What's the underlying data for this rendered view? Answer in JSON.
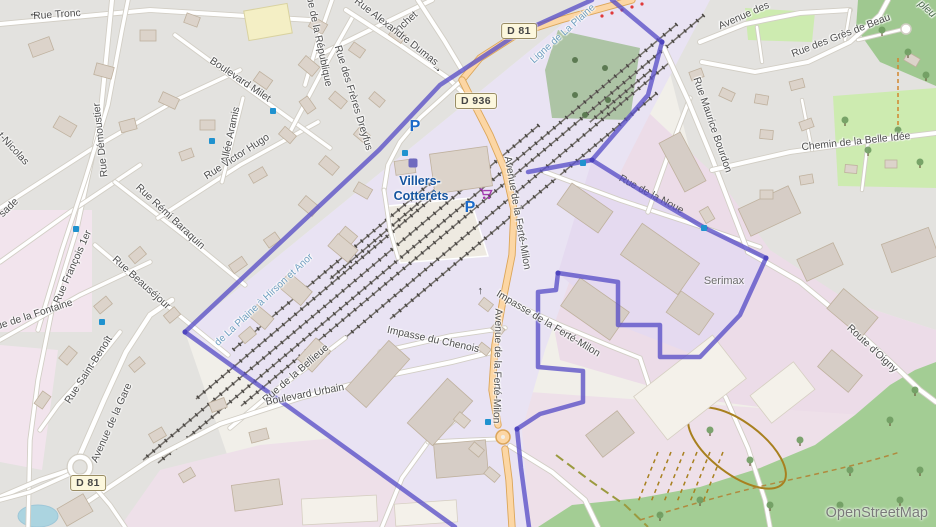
{
  "map": {
    "attribution": "OpenStreetMap",
    "station": {
      "line1": "Villers-",
      "line2": "Cotterêts",
      "x": 420,
      "y1": 181,
      "y2": 196
    },
    "poi_labels": [
      {
        "t": "Serimax",
        "x": 724,
        "y": 281
      }
    ],
    "forest_label": {
      "t": "pleu",
      "x": 927,
      "y": 9,
      "r": 42
    },
    "road_badges": [
      {
        "ref": "D 81",
        "x": 519,
        "y": 31
      },
      {
        "ref": "D 936",
        "x": 476,
        "y": 101
      },
      {
        "ref": "D 81",
        "x": 88,
        "y": 483
      }
    ],
    "street_labels": [
      {
        "t": "Rue Tronc",
        "x": 57,
        "y": 15,
        "r": -4
      },
      {
        "t": "nchet",
        "x": 407,
        "y": 22,
        "r": -42
      },
      {
        "t": "Rue de la République",
        "x": 318,
        "y": 38,
        "r": 78
      },
      {
        "t": "Rue Alexandre Dumas",
        "x": 396,
        "y": 32,
        "r": 38
      },
      {
        "t": "Rue des Frères Dreyfus",
        "x": 353,
        "y": 98,
        "r": 73
      },
      {
        "t": "Rue Démoustier",
        "x": 101,
        "y": 140,
        "r": -96
      },
      {
        "t": "Boulevard Milet",
        "x": 240,
        "y": 80,
        "r": 34
      },
      {
        "t": "Allée Aramis",
        "x": 231,
        "y": 135,
        "r": -78
      },
      {
        "t": "Rue Victor Hugo",
        "x": 237,
        "y": 157,
        "r": -33
      },
      {
        "t": "t-Nicolas",
        "x": 13,
        "y": 149,
        "r": 47
      },
      {
        "t": "sade",
        "x": 9,
        "y": 208,
        "r": -44
      },
      {
        "t": "Rue François 1er",
        "x": 73,
        "y": 267,
        "r": -66
      },
      {
        "t": "Rue Rémi Baraquin",
        "x": 170,
        "y": 217,
        "r": 43
      },
      {
        "t": "Rue Beauséjour",
        "x": 141,
        "y": 283,
        "r": 42
      },
      {
        "t": "Rue de la Fontaine",
        "x": 31,
        "y": 316,
        "r": -18
      },
      {
        "t": "Rue Saint-Benoît",
        "x": 89,
        "y": 370,
        "r": -57
      },
      {
        "t": "Avenue de la Gare",
        "x": 112,
        "y": 423,
        "r": -66
      },
      {
        "t": "Avenue de la Ferté-Milon",
        "x": 517,
        "y": 213,
        "r": 80
      },
      {
        "t": "Avenue de la Ferté-Milon",
        "x": 497,
        "y": 366,
        "r": 91
      },
      {
        "t": "Impasse de la Ferté-Milon",
        "x": 548,
        "y": 324,
        "r": 31
      },
      {
        "t": "Impasse du Chenois",
        "x": 433,
        "y": 340,
        "r": 12
      },
      {
        "t": "Rue de la Bellieue",
        "x": 296,
        "y": 374,
        "r": -41
      },
      {
        "t": "Boulevard Urbain",
        "x": 305,
        "y": 395,
        "r": -11
      },
      {
        "t": "Rue Maurice Bourdon",
        "x": 712,
        "y": 125,
        "r": 71
      },
      {
        "t": "Chemin de la Belle Idée",
        "x": 856,
        "y": 142,
        "r": -6
      },
      {
        "t": "Rue des Grès de Beau",
        "x": 841,
        "y": 36,
        "r": -21
      },
      {
        "t": "Avenue des",
        "x": 744,
        "y": 16,
        "r": -24
      },
      {
        "t": "Route d'Oigny",
        "x": 872,
        "y": 349,
        "r": 43
      }
    ],
    "railway_labels": [
      {
        "t": "Ligne de La Plaine",
        "x": 563,
        "y": 34,
        "r": -42
      },
      {
        "t": "de La Plaine à Hirson et Anor",
        "x": 264,
        "y": 300,
        "r": -43
      }
    ],
    "hidden_street_label": {
      "t": "Rue de la Noue",
      "x": 650,
      "y": 197,
      "r": 28
    },
    "icons": {
      "parking_glyph": "P",
      "parking": [
        {
          "x": 415,
          "y": 127
        },
        {
          "x": 470,
          "y": 208
        }
      ],
      "supermarket_cart": {
        "x": 479,
        "y": 188
      },
      "station_square": {
        "x": 413,
        "y": 163
      },
      "bus_stops": [
        {
          "x": 273,
          "y": 111
        },
        {
          "x": 212,
          "y": 141
        },
        {
          "x": 76,
          "y": 229
        },
        {
          "x": 102,
          "y": 322
        },
        {
          "x": 405,
          "y": 153
        },
        {
          "x": 583,
          "y": 163
        },
        {
          "x": 704,
          "y": 228
        },
        {
          "x": 488,
          "y": 422
        }
      ],
      "oneway_glyph": "→",
      "oneway_arrows": [
        {
          "x": 34,
          "y": 16,
          "r": 180
        },
        {
          "x": 437,
          "y": 68,
          "r": 35
        },
        {
          "x": 479,
          "y": 291,
          "r": -90
        }
      ]
    },
    "colors": {
      "boundary": "#5a50c7",
      "primary_road": "#fcd6a4",
      "residential": "#e3e2df",
      "industrial": "#ecdce8",
      "railway_landuse": "#e9e3f3",
      "forest": "#a3cd94",
      "grass": "#cdebb0",
      "water": "#abd4e0",
      "station_text": "#14549f",
      "railway_text": "#6f9ec0"
    }
  }
}
